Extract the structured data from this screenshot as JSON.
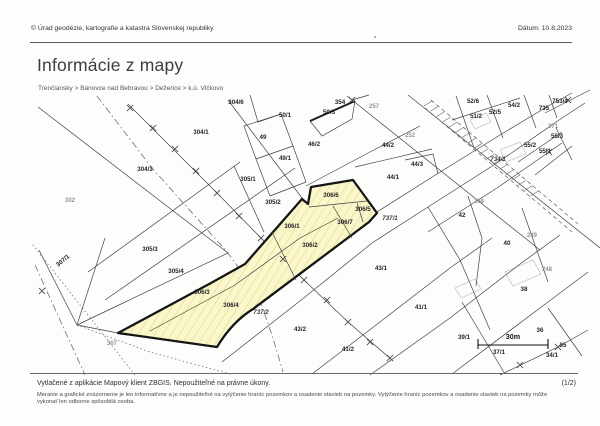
{
  "header": {
    "copyright": "© Úrad geodézie, kartografie a katastra Slovenskej republiky",
    "date": "Dátum: 10.8.2023"
  },
  "title": "Informácie z mapy",
  "breadcrumb": "Trenčiansky > Bánovce nad Bebravou > Dežerice > k.ú. Vlčkovo",
  "map": {
    "highlight_color": "#fbf7cd",
    "outline_color": "#151515",
    "scale_label": "30m",
    "labels": [
      [
        "304/6",
        236,
        104
      ],
      [
        "304/1",
        201,
        134
      ],
      [
        "304/3",
        145,
        171
      ],
      [
        "305/1",
        248,
        181
      ],
      [
        "305/2",
        273,
        204
      ],
      [
        "305/3",
        150,
        251
      ],
      [
        "305/4",
        176,
        273
      ],
      [
        "306/1",
        292,
        228
      ],
      [
        "306/2",
        310,
        247
      ],
      [
        "306/3",
        202,
        294
      ],
      [
        "306/4",
        231,
        307
      ],
      [
        "306/6",
        331,
        197
      ],
      [
        "306/5",
        363,
        211
      ],
      [
        "306/7",
        345,
        224
      ],
      [
        "49",
        263,
        139
      ],
      [
        "49/1",
        285,
        160
      ],
      [
        "46/2",
        314,
        146
      ],
      [
        "50/1",
        285,
        117
      ],
      [
        "50/3",
        329,
        114
      ],
      [
        "354",
        340,
        104
      ],
      [
        "44/2",
        388,
        147
      ],
      [
        "44/3",
        417,
        166
      ],
      [
        "44/1",
        393,
        179
      ],
      [
        "43/1",
        381,
        270
      ],
      [
        "43/2",
        300,
        331
      ],
      [
        "41/2",
        348,
        351
      ],
      [
        "41/1",
        421,
        309
      ],
      [
        "42",
        462,
        217
      ],
      [
        "40",
        507,
        245
      ],
      [
        "38",
        524,
        291
      ],
      [
        "39/1",
        464,
        339
      ],
      [
        "37/1",
        499,
        354
      ],
      [
        "36",
        540,
        332
      ],
      [
        "35",
        563,
        347
      ],
      [
        "34/1",
        552,
        357
      ],
      [
        "51/2",
        476,
        118
      ],
      [
        "52/5",
        495,
        114
      ],
      [
        "52/6",
        473,
        103
      ],
      [
        "54/2",
        514,
        107
      ],
      [
        "735",
        544,
        110
      ],
      [
        "753/4",
        560,
        103
      ],
      [
        "55/3",
        557,
        138
      ],
      [
        "55/2",
        530,
        147
      ],
      [
        "55/1",
        545,
        153
      ],
      [
        "737/1",
        390,
        220,
        "i"
      ],
      [
        "737/2",
        261,
        314,
        "i"
      ],
      [
        "734/1",
        498,
        161,
        "i"
      ],
      [
        "307/1",
        64,
        262,
        "r"
      ],
      [
        "30m",
        513,
        339,
        "b"
      ],
      [
        "302",
        70,
        202,
        "g"
      ],
      [
        "307",
        112,
        345,
        "g"
      ],
      [
        "257",
        374,
        108,
        "g"
      ],
      [
        "252",
        410,
        137,
        "g"
      ],
      [
        "271",
        553,
        128,
        "g"
      ],
      [
        "258",
        479,
        203,
        "g"
      ],
      [
        "249",
        532,
        237,
        "g"
      ],
      [
        "248",
        547,
        271,
        "g"
      ]
    ]
  },
  "footer": {
    "printed": "Vytlačené z aplikácie Mapový klient ZBGIS. Nepoužiteľné na právne úkony.",
    "page": "(1/2)",
    "disclaimer": "Meranie a grafické znázornenie je len informatívne a je nepoužiteľné na vytýčenie hraníc pozemkov a osadenie stavieb na pozemky. Vytýčenie hraníc pozemkov a osadenie stavieb na pozemky môže vykonať len odborne spôsobilá osoba."
  }
}
